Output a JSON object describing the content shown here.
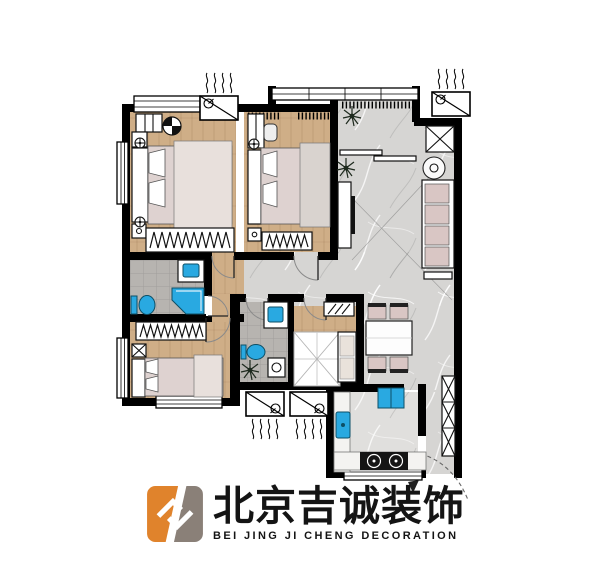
{
  "logo": {
    "cn": "北京吉诚装饰",
    "en": "BEI JING JI CHENG DECORATION"
  },
  "palette": {
    "bg": "#ffffff",
    "wall": "#000000",
    "wood": "#cfae87",
    "marble": "#d6d5d3",
    "marble_light": "#e0dfdd",
    "tile": "#b7b4b0",
    "fixture_blue": "#29a9e1",
    "fixture_blue_dark": "#0d4f66",
    "bed": "#ded2d0",
    "blanket": "#e8e0dc",
    "cushion": "#d9c6c4",
    "logo_orange": "#e0832c",
    "logo_gray": "#8a8078",
    "text": "#141414"
  },
  "floorplan": {
    "type": "residential apartment floor plan, top-down, furnished",
    "rooms": [
      "master-bedroom",
      "bedroom-2",
      "bedroom-3",
      "bathroom-1",
      "bathroom-2",
      "living-room",
      "hallway",
      "dining-area",
      "kitchen",
      "balcony",
      "entry",
      "study-nook"
    ],
    "furniture": [
      "double-bed x3",
      "wardrobe x3",
      "sofa with 4 cushions",
      "round-side-table",
      "tv-cabinet",
      "dining-table with 4 chairs",
      "corner-shower",
      "toilet x2",
      "wash-basin x2",
      "kitchen-sink",
      "fridge",
      "gas-stove 2 burners",
      "shoe-cabinet",
      "air-conditioner outdoor unit x4",
      "potted-plant x3"
    ]
  }
}
